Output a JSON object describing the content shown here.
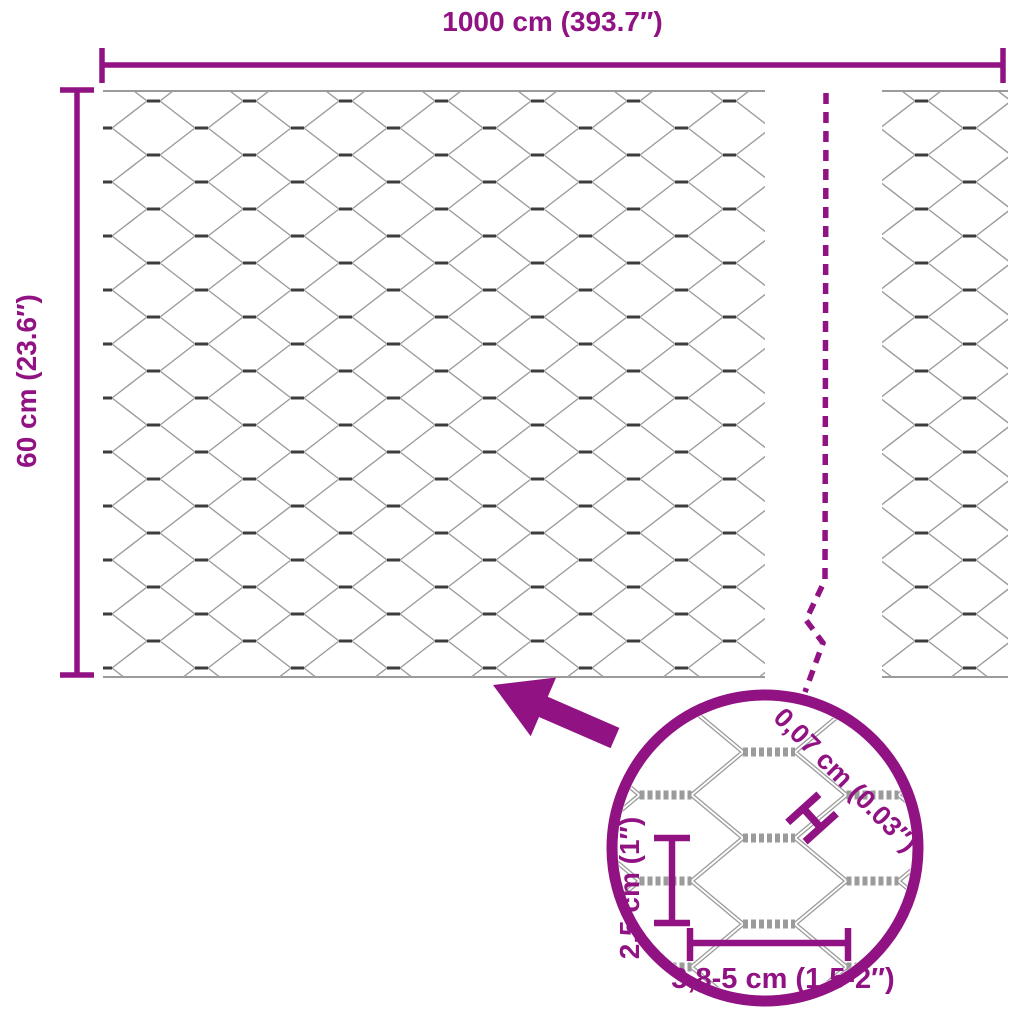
{
  "labels": {
    "total_width": "1000 cm (393.7″)",
    "total_height": "60 cm (23.6″)",
    "wire_thickness": "0,07 cm (0.03″)",
    "mesh_height": "2,5 cm (1″)",
    "mesh_width": "3,8-5 cm (1.5-2″)"
  },
  "colors": {
    "accent": "#911283",
    "mesh_wire": "#9b9b9b",
    "mesh_twist": "#3d3d3d"
  },
  "icons": {
    "detail_arrow": "arrow-up-left",
    "detail_circle": "magnifier-detail-circle",
    "break_line": "dashed-continuation-break",
    "wire_thickness_marker": "caliper-h-marker"
  }
}
